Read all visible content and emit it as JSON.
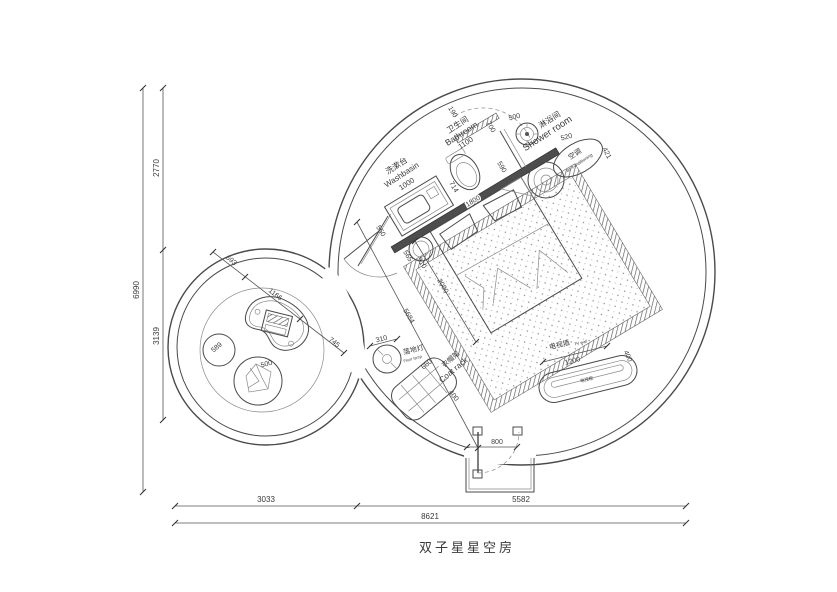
{
  "title": "双子星星空房",
  "colors": {
    "line": "#4a4a4a",
    "text": "#3a3a3a",
    "wall": "#4d4d4d",
    "background": "#ffffff"
  },
  "plan": {
    "type": "architectural-floor-plan",
    "rooms": [
      {
        "name_cn": "卫生间",
        "name_en": "Bathroom",
        "width_mm": 1100
      },
      {
        "name_cn": "淋浴间",
        "name_en": "Shower room"
      },
      {
        "name_cn": "洗漱台",
        "name_en": "Washbasin",
        "width_mm": 1000
      }
    ],
    "fixtures": [
      {
        "name_cn": "空调",
        "name_en": "air-conditioning"
      },
      {
        "name_cn": "落地灯",
        "name_en": "Floor lamp",
        "dim_mm": 310
      },
      {
        "name_cn": "衣帽架",
        "name_en": "Coat rack",
        "dims_mm": [
          660,
          400
        ]
      },
      {
        "name_cn": "电视墙",
        "name_en": "TV wall",
        "dims_mm": [
          1200,
          400
        ]
      },
      {
        "name_cn": "电视柜"
      }
    ],
    "overall_mm": {
      "width": 8621,
      "height": 6990
    },
    "segments_mm": {
      "left_top": 2770,
      "left_bottom": 3139,
      "bottom_left": 3033,
      "bottom_right": 5582
    },
    "interior_dims_mm": [
      190,
      700,
      500,
      590,
      520,
      421,
      550,
      714,
      1000,
      1100,
      1800,
      565,
      910,
      2000,
      5684,
      745,
      693,
      1166,
      589,
      500,
      310,
      660,
      400,
      1200,
      400,
      800
    ]
  },
  "annotations": [
    {
      "name": "dim-6990",
      "text": "6990",
      "x": 139,
      "y": 290,
      "rot": -90,
      "size": 8
    },
    {
      "name": "dim-2770",
      "text": "2770",
      "x": 159,
      "y": 168,
      "rot": -90,
      "size": 8
    },
    {
      "name": "dim-3139",
      "text": "3139",
      "x": 159,
      "y": 336,
      "rot": -90,
      "size": 8
    },
    {
      "name": "dim-3033",
      "text": "3033",
      "x": 266,
      "y": 502,
      "size": 8
    },
    {
      "name": "dim-5582",
      "text": "5582",
      "x": 521,
      "y": 502,
      "size": 8
    },
    {
      "name": "dim-8621",
      "text": "8621",
      "x": 430,
      "y": 519,
      "size": 8
    },
    {
      "name": "label-washbasin-cn",
      "text": "洗漱台",
      "x": 398,
      "y": 168,
      "rot": -33,
      "size": 8
    },
    {
      "name": "label-washbasin-en",
      "text": "Washbasin",
      "x": 403,
      "y": 177,
      "rot": -33,
      "size": 8
    },
    {
      "name": "dim-washbasin-1000",
      "text": "1000",
      "x": 408,
      "y": 186,
      "rot": -33,
      "size": 7.5
    },
    {
      "name": "label-bathroom-cn",
      "text": "卫生间",
      "x": 459,
      "y": 127,
      "rot": -33,
      "size": 8
    },
    {
      "name": "label-bathroom-en",
      "text": "Bathroom",
      "x": 463,
      "y": 136,
      "rot": -33,
      "size": 8.5
    },
    {
      "name": "dim-bathroom-1100",
      "text": "1100",
      "x": 467,
      "y": 145,
      "rot": -33,
      "size": 7.5
    },
    {
      "name": "label-shower-cn",
      "text": "淋浴间",
      "x": 551,
      "y": 122,
      "rot": -33,
      "size": 8
    },
    {
      "name": "label-shower-en",
      "text": "Shower room",
      "x": 549,
      "y": 136,
      "rot": -33,
      "size": 9.5
    },
    {
      "name": "label-ac-cn",
      "text": "空调",
      "x": 576,
      "y": 156,
      "rot": -33,
      "size": 7
    },
    {
      "name": "label-ac-en",
      "text": "air-conditioning",
      "x": 580,
      "y": 164,
      "rot": -33,
      "size": 4.5
    },
    {
      "name": "dim-190",
      "text": "190",
      "x": 451,
      "y": 113,
      "rot": 59,
      "size": 7
    },
    {
      "name": "dim-700",
      "text": "700",
      "x": 489,
      "y": 128,
      "rot": 59,
      "size": 7
    },
    {
      "name": "dim-500-shower",
      "text": "500",
      "x": 515,
      "y": 119,
      "rot": -15,
      "size": 7
    },
    {
      "name": "dim-590",
      "text": "590",
      "x": 500,
      "y": 168,
      "rot": 59,
      "size": 7
    },
    {
      "name": "dim-520",
      "text": "520",
      "x": 567,
      "y": 139,
      "rot": -15,
      "size": 7
    },
    {
      "name": "dim-421",
      "text": "421",
      "x": 605,
      "y": 154,
      "rot": 62,
      "size": 7
    },
    {
      "name": "dim-550",
      "text": "550",
      "x": 379,
      "y": 232,
      "rot": 59,
      "size": 7
    },
    {
      "name": "dim-714",
      "text": "714",
      "x": 452,
      "y": 188,
      "rot": 59,
      "size": 7
    },
    {
      "name": "dim-1800",
      "text": "1800",
      "x": 474,
      "y": 203,
      "rot": -31,
      "size": 7,
      "halo": true
    },
    {
      "name": "dim-565",
      "text": "565",
      "x": 406,
      "y": 257,
      "rot": 59,
      "size": 7
    },
    {
      "name": "dim-910",
      "text": "910",
      "x": 420,
      "y": 264,
      "rot": 59,
      "size": 7
    },
    {
      "name": "dim-2000",
      "text": "2000",
      "x": 441,
      "y": 287,
      "rot": 59,
      "size": 7
    },
    {
      "name": "dim-5684",
      "text": "5684",
      "x": 407,
      "y": 317,
      "rot": 59,
      "size": 7
    },
    {
      "name": "dim-745",
      "text": "745",
      "x": 333,
      "y": 344,
      "rot": 38,
      "size": 7
    },
    {
      "name": "dim-693",
      "text": "693",
      "x": 230,
      "y": 262,
      "rot": 38,
      "size": 7
    },
    {
      "name": "dim-1166",
      "text": "1166",
      "x": 274,
      "y": 296,
      "rot": 38,
      "size": 7
    },
    {
      "name": "dim-589",
      "text": "589",
      "x": 218,
      "y": 349,
      "rot": -40,
      "size": 7
    },
    {
      "name": "dim-500-chair",
      "text": "500",
      "x": 267,
      "y": 366,
      "rot": -15,
      "size": 7
    },
    {
      "name": "dim-310",
      "text": "310",
      "x": 382,
      "y": 341,
      "rot": -15,
      "size": 7
    },
    {
      "name": "label-floorlamp-cn",
      "text": "落地灯",
      "x": 414,
      "y": 352,
      "rot": -15,
      "size": 7
    },
    {
      "name": "label-floorlamp-en",
      "text": "Floor lamp",
      "x": 413,
      "y": 360,
      "rot": -15,
      "size": 4
    },
    {
      "name": "dim-660",
      "text": "660",
      "x": 428,
      "y": 366,
      "rot": -40,
      "size": 7
    },
    {
      "name": "label-coatrack-cn",
      "text": "衣帽架",
      "x": 452,
      "y": 361,
      "rot": -40,
      "size": 7
    },
    {
      "name": "label-coatrack-en",
      "text": "Coat rack",
      "x": 455,
      "y": 372,
      "rot": -40,
      "size": 8
    },
    {
      "name": "dim-400-coatrack",
      "text": "400",
      "x": 452,
      "y": 397,
      "rot": 50,
      "size": 7
    },
    {
      "name": "label-tvwall-cn",
      "text": "电视墙",
      "x": 560,
      "y": 347,
      "rot": -14,
      "size": 7
    },
    {
      "name": "label-tvwall-en",
      "text": "TV wall",
      "x": 581,
      "y": 344,
      "rot": -14,
      "size": 4
    },
    {
      "name": "dim-1200",
      "text": "1200",
      "x": 573,
      "y": 363,
      "rot": -14,
      "size": 7
    },
    {
      "name": "dim-400-tv",
      "text": "400",
      "x": 626,
      "y": 357,
      "rot": 65,
      "size": 7
    },
    {
      "name": "label-tvcabinet",
      "text": "电视柜",
      "x": 587,
      "y": 381,
      "rot": -14,
      "size": 4.5
    },
    {
      "name": "dim-800",
      "text": "800",
      "x": 497,
      "y": 444,
      "size": 7
    }
  ]
}
